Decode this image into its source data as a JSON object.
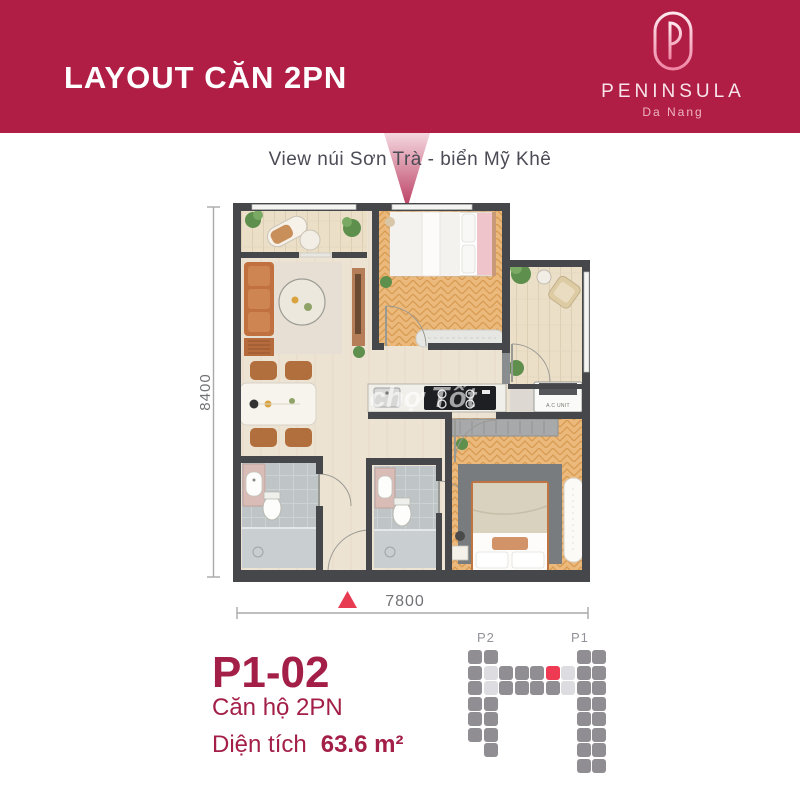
{
  "header": {
    "title": "LAYOUT CĂN 2PN",
    "logo": {
      "monogram": "P",
      "name": "PENINSULA",
      "location": "Da Nang"
    }
  },
  "view_label": "View núi Sơn Trà - biển Mỹ Khê",
  "floor_plan": {
    "dim_height": "8400",
    "dim_width": "7800",
    "ac_label": "A.C UNIT",
    "watermark": "chợ Tốt"
  },
  "unit_info": {
    "code": "P1-02",
    "type_label": "Căn hộ 2PN",
    "area_label": "Diện tích",
    "area_value": "63.6 m²"
  },
  "building_diagram": {
    "tower_left_label": "P2",
    "tower_right_label": "P1",
    "grid": [
      "GG.....GG",
      "GLGGGRLGG",
      "GLGGGGLGG",
      "GG.....GG",
      "GG.....GG",
      "GG.....GG",
      ".G.....GG",
      ".......GG"
    ],
    "legend": {
      "G": "unit",
      "L": "corridor",
      "R": "highlighted-unit",
      ".": "empty"
    }
  },
  "colors": {
    "header_bg": "#B01E45",
    "crimson_text": "#A31F47",
    "accent_red": "#EE3A53",
    "wall": "#45474B",
    "wood_floor": "#ECB97C",
    "tile_floor": "#BFC4C6",
    "building_unit_gray": "#908E93",
    "building_corridor": "#DDDCE0"
  }
}
